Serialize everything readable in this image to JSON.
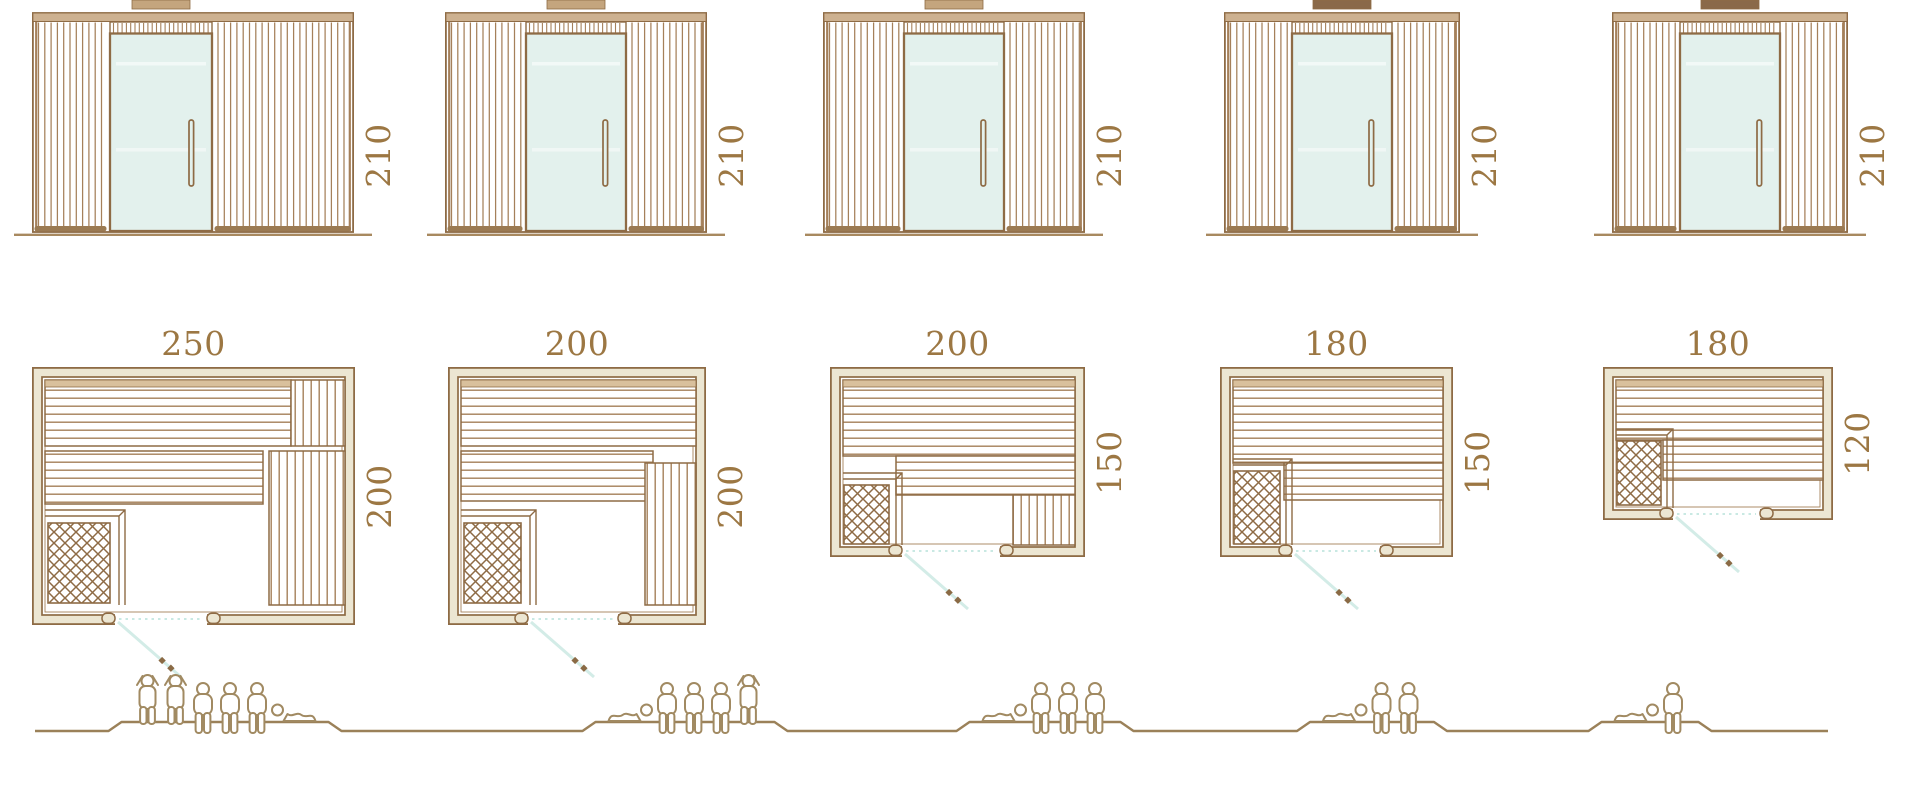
{
  "diagram": {
    "title": "Sauna cabin sizes: elevations, floor plans and seating capacity",
    "units": [
      {
        "elevation_height": "210",
        "plan_width": "250",
        "plan_depth": "200",
        "capacity": {
          "standing": 2,
          "sitting": 3,
          "lying": 1,
          "total": 6
        },
        "figure_order": [
          "standing",
          "standing",
          "sitting",
          "sitting",
          "sitting",
          "lying"
        ]
      },
      {
        "elevation_height": "210",
        "plan_width": "200",
        "plan_depth": "200",
        "capacity": {
          "standing": 1,
          "sitting": 3,
          "lying": 1,
          "total": 5
        },
        "figure_order": [
          "lying",
          "sitting",
          "sitting",
          "sitting",
          "standing"
        ]
      },
      {
        "elevation_height": "210",
        "plan_width": "200",
        "plan_depth": "150",
        "capacity": {
          "standing": 0,
          "sitting": 3,
          "lying": 1,
          "total": 4
        },
        "figure_order": [
          "lying",
          "sitting",
          "sitting",
          "sitting"
        ]
      },
      {
        "elevation_height": "210",
        "plan_width": "180",
        "plan_depth": "150",
        "capacity": {
          "standing": 0,
          "sitting": 2,
          "lying": 1,
          "total": 3
        },
        "figure_order": [
          "lying",
          "sitting",
          "sitting"
        ]
      },
      {
        "elevation_height": "210",
        "plan_width": "180",
        "plan_depth": "120",
        "capacity": {
          "standing": 0,
          "sitting": 1,
          "lying": 1,
          "total": 2
        },
        "figure_order": [
          "lying",
          "sitting"
        ]
      }
    ],
    "colors": {
      "outline": "#8e6b45",
      "wood_line": "#a5805a",
      "wall_fill": "#ece6d2",
      "glass": "#e3f1ed",
      "teal": "#c9e9e3",
      "label": "#9c7743",
      "people": "#a18a62",
      "ground": "#9b8159",
      "base_bar": "#9b7a52",
      "vent_light": "#c4a57e",
      "vent_dark": "#8a6949",
      "bench_top": "#d9c09c"
    }
  }
}
